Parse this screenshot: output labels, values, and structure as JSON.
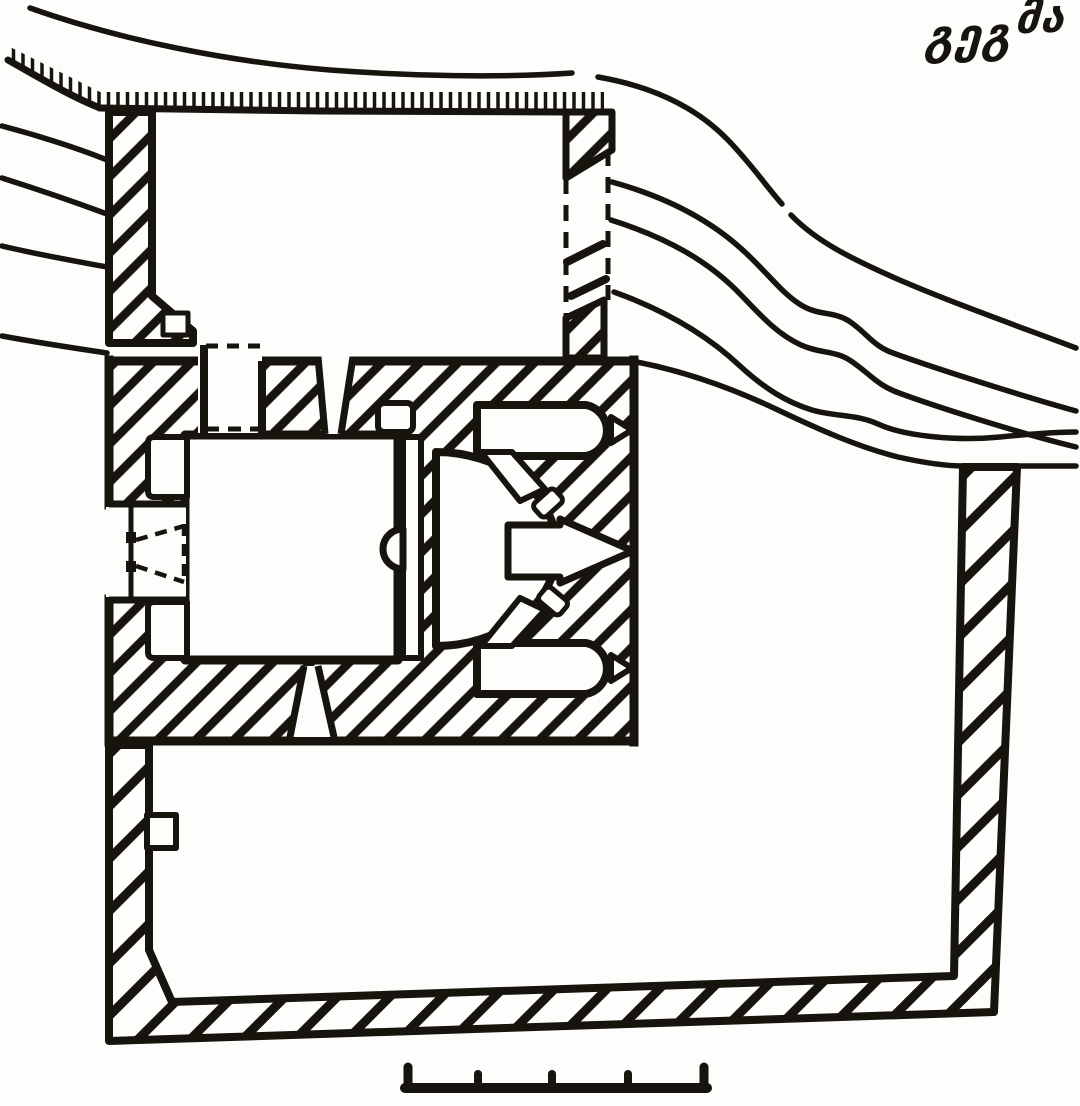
{
  "page": {
    "paper_color": "#fdfdfb",
    "ink_color": "#17130d"
  },
  "title": {
    "text": "გეგმა",
    "part_main": "გეგ",
    "part_raised": "მა"
  },
  "plan": {
    "features": [
      "cliff-edge-hatching",
      "terrain-contour-lines",
      "upper-courtyard",
      "left-curtain-wall",
      "ruined-east-wall-dashed",
      "church-block",
      "nave",
      "north-door",
      "west-door",
      "altar-platform",
      "apse",
      "apse-central-window",
      "apse-diagonal-niches",
      "north-chamber",
      "south-chamber",
      "chamber-windows",
      "splayed-windows",
      "wall-niches",
      "lower-courtyard",
      "enclosure-wall",
      "wall-pilaster",
      "scale-bar"
    ],
    "scale_bar": {
      "segments": 4,
      "tick_count": 5
    }
  }
}
